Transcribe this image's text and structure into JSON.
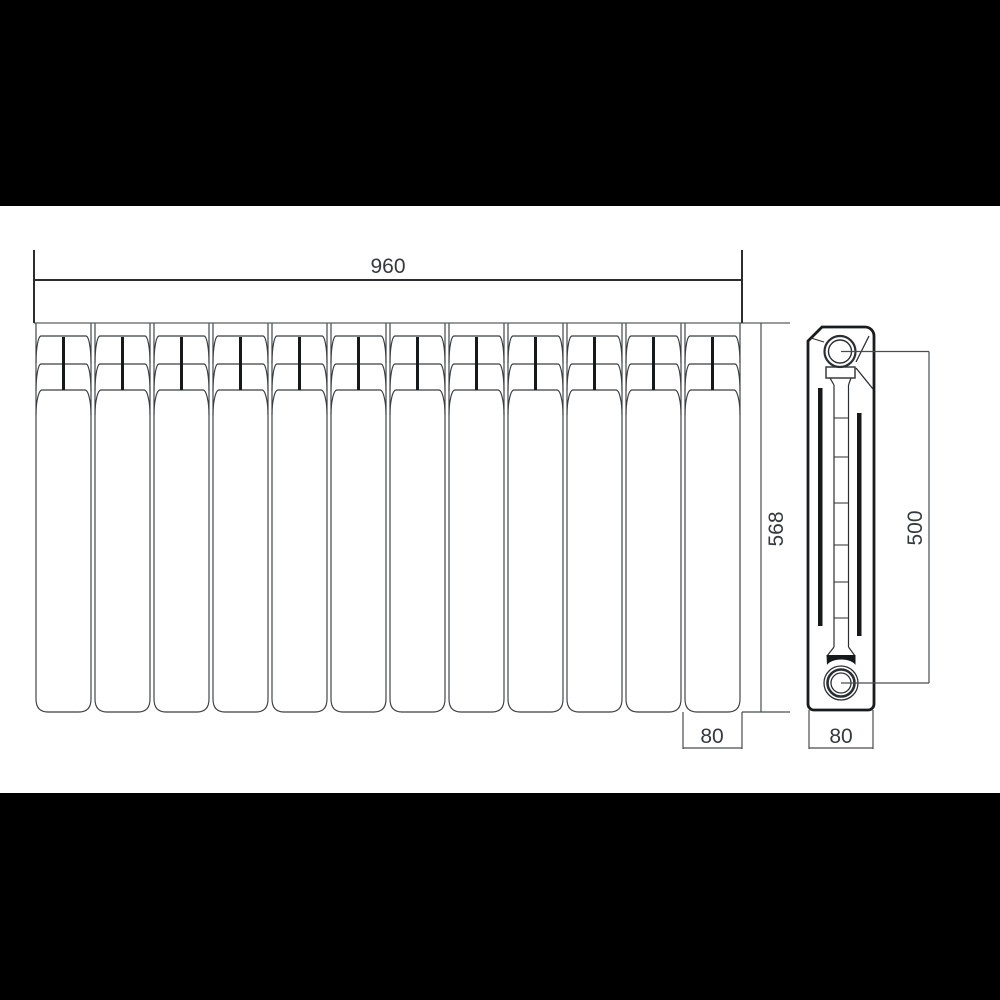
{
  "letterbox": {
    "color": "#000000"
  },
  "canvas": {
    "background": "#ffffff"
  },
  "drawing": {
    "type": "technical-drawing",
    "front_view": {
      "section_count": 12
    },
    "dimensions": {
      "overall_width": "960",
      "overall_height": "568",
      "axis_height": "500",
      "section_width": "80",
      "depth": "80"
    },
    "colors": {
      "line": "#3b3d41",
      "strong": "#202225",
      "text": "#35383d",
      "fill": "#17181a"
    }
  }
}
